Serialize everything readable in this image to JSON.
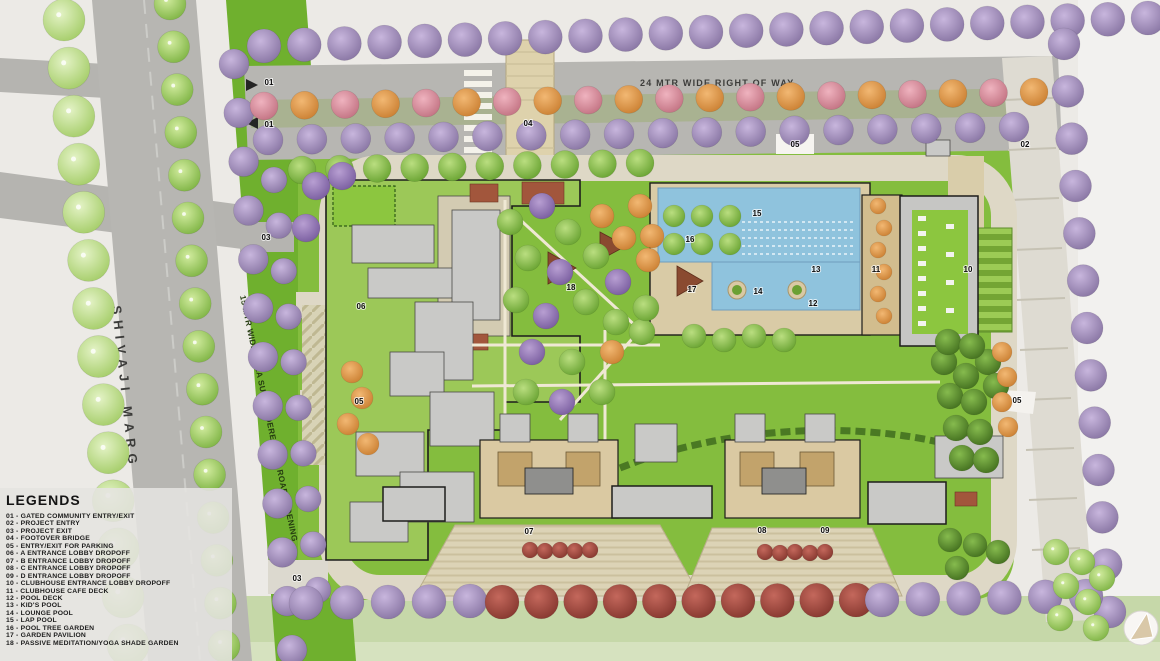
{
  "legend": {
    "title": "LEGENDS",
    "items": [
      {
        "code": "01",
        "label": "GATED COMMUNITY ENTRY/EXIT"
      },
      {
        "code": "02",
        "label": "PROJECT ENTRY"
      },
      {
        "code": "03",
        "label": "PROJECT EXIT"
      },
      {
        "code": "04",
        "label": "FOOTOVER BRIDGE"
      },
      {
        "code": "05",
        "label": "ENTRY/EXIT FOR PARKING"
      },
      {
        "code": "06",
        "label": "A ENTRANCE LOBBY DROPOFF"
      },
      {
        "code": "07",
        "label": "B ENTRANCE LOBBY DROPOFF"
      },
      {
        "code": "08",
        "label": "C ENTRANCE LOBBY DROPOFF"
      },
      {
        "code": "09",
        "label": "D ENTRANCE LOBBY DROPOFF"
      },
      {
        "code": "10",
        "label": "CLUBHOUSE ENTRANCE LOBBY DROPOFF"
      },
      {
        "code": "11",
        "label": "CLUBHOUSE CAFE DECK"
      },
      {
        "code": "12",
        "label": "POOL DECK"
      },
      {
        "code": "13",
        "label": "KID'S POOL"
      },
      {
        "code": "14",
        "label": "LOUNGE POOL"
      },
      {
        "code": "15",
        "label": "LAP POOL"
      },
      {
        "code": "16",
        "label": "POOL TREE GARDEN"
      },
      {
        "code": "17",
        "label": "GARDEN PAVILION"
      },
      {
        "code": "18",
        "label": "PASSIVE MEDITATION/YOGA SHADE GARDEN"
      }
    ]
  },
  "road_labels": {
    "shivaji_marg": "SHIVAJI MARG",
    "right_of_way": "24 MTR WIDE RIGHT OF WAY",
    "road_widening": "15 MTR WIDE AREA SURRENDERED FOR ROAD WIDENING"
  },
  "markers": [
    {
      "code": "01",
      "x": 269,
      "y": 85
    },
    {
      "code": "01",
      "x": 269,
      "y": 127
    },
    {
      "code": "02",
      "x": 1025,
      "y": 147
    },
    {
      "code": "03",
      "x": 266,
      "y": 240
    },
    {
      "code": "03",
      "x": 297,
      "y": 581
    },
    {
      "code": "04",
      "x": 528,
      "y": 126
    },
    {
      "code": "05",
      "x": 795,
      "y": 147
    },
    {
      "code": "05",
      "x": 359,
      "y": 404
    },
    {
      "code": "05",
      "x": 1017,
      "y": 403
    },
    {
      "code": "06",
      "x": 361,
      "y": 309
    },
    {
      "code": "07",
      "x": 529,
      "y": 534
    },
    {
      "code": "08",
      "x": 762,
      "y": 533
    },
    {
      "code": "09",
      "x": 825,
      "y": 533
    },
    {
      "code": "10",
      "x": 968,
      "y": 272
    },
    {
      "code": "11",
      "x": 876,
      "y": 272
    },
    {
      "code": "12",
      "x": 813,
      "y": 306
    },
    {
      "code": "13",
      "x": 816,
      "y": 272
    },
    {
      "code": "14",
      "x": 758,
      "y": 294
    },
    {
      "code": "15",
      "x": 757,
      "y": 216
    },
    {
      "code": "16",
      "x": 690,
      "y": 242
    },
    {
      "code": "17",
      "x": 692,
      "y": 292
    },
    {
      "code": "18",
      "x": 571,
      "y": 290
    }
  ],
  "colors": {
    "lawn": "#84bd3e",
    "pool_water": "#8fc3dd",
    "road_grey": "#b7b6b2",
    "widening_strip": "#6fb02e",
    "tree_purple": "#8b77ad",
    "deck_tan": "#dac9a2"
  }
}
